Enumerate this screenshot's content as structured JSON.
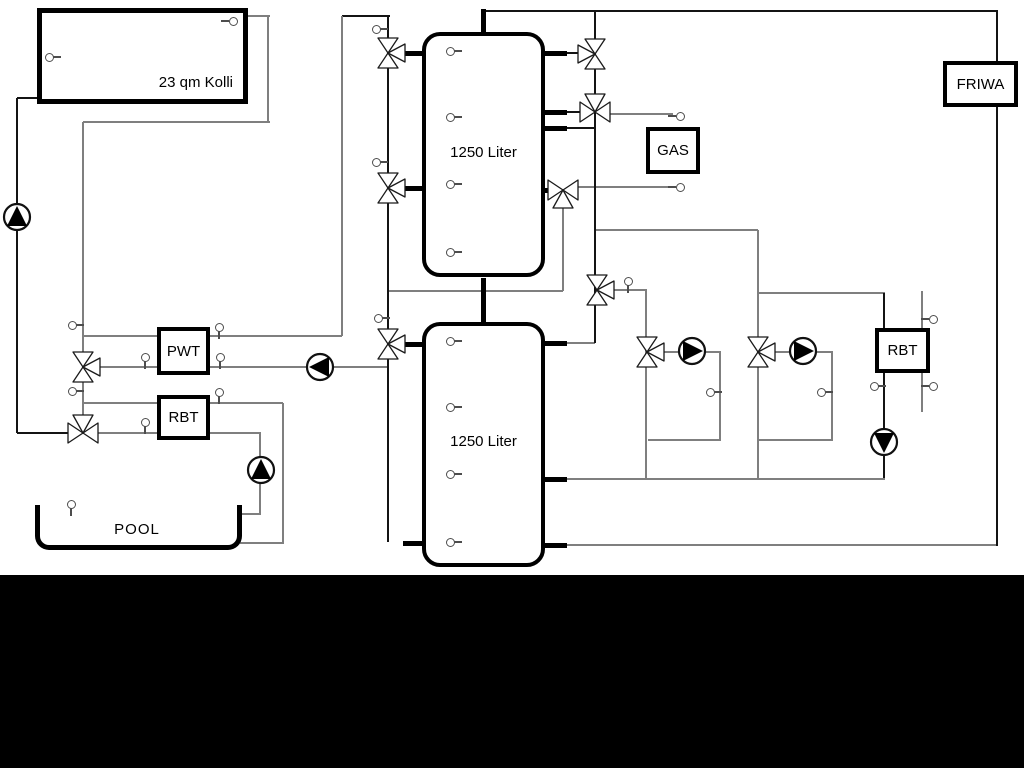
{
  "diagram": {
    "labels": {
      "collector": "23 qm Kolli",
      "tank_upper": "1250 Liter",
      "tank_lower": "1250 Liter",
      "gas": "GAS",
      "friwa": "FRIWA",
      "pwt": "PWT",
      "rbt_left": "RBT",
      "rbt_right": "RBT",
      "pool": "POOL"
    },
    "colors": {
      "background": "#ffffff",
      "pipe_gray": "#7f7f7f",
      "pipe_black": "#141414",
      "equipment_border": "#000000",
      "bottom_band": "#000000"
    },
    "icons": {
      "valve": "three-way-valve-icon",
      "pump": "pump-icon",
      "sensor": "temperature-sensor-icon"
    }
  }
}
